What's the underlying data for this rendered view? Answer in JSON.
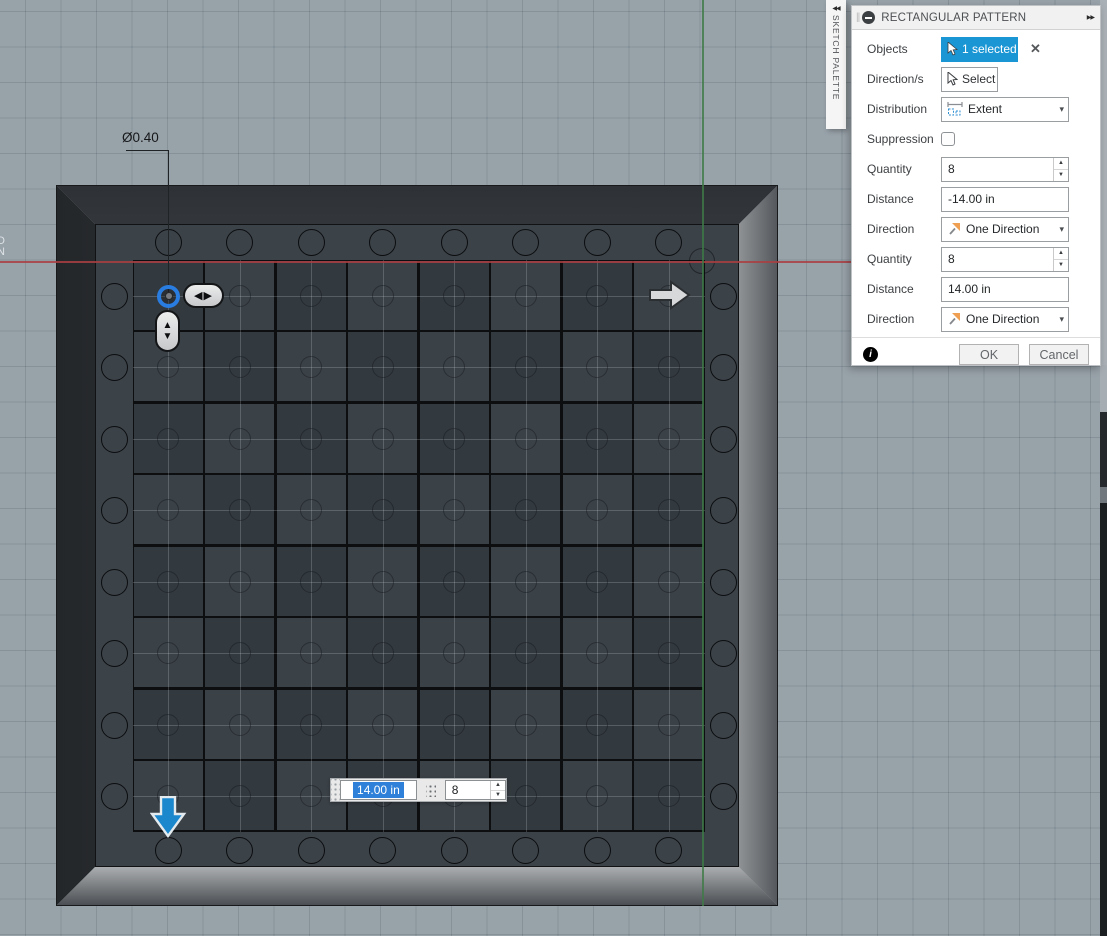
{
  "dialog": {
    "title": "RECTANGULAR PATTERN",
    "rows": {
      "objects_label": "Objects",
      "objects_value": "1 selected",
      "directions_label": "Direction/s",
      "directions_value": "Select",
      "distribution_label": "Distribution",
      "distribution_value": "Extent",
      "suppression_label": "Suppression",
      "quantity1_label": "Quantity",
      "quantity1_value": "8",
      "distance1_label": "Distance",
      "distance1_value": "-14.00 in",
      "direction1_label": "Direction",
      "direction1_value": "One Direction",
      "quantity2_label": "Quantity",
      "quantity2_value": "8",
      "distance2_label": "Distance",
      "distance2_value": "14.00 in",
      "direction2_label": "Direction",
      "direction2_value": "One Direction"
    },
    "ok_label": "OK",
    "cancel_label": "Cancel"
  },
  "sketch_palette": {
    "label": "SKETCH PALETTE"
  },
  "canvas": {
    "dimension_label": "Ø0.40",
    "floating_inputs": {
      "distance_value": "14.00 in",
      "quantity_value": "8"
    },
    "clipped_text_line1": "D",
    "clipped_text_line2": "N",
    "pattern": {
      "columns": 8,
      "rows": 8
    },
    "holes_per_side": 8
  },
  "icons": {
    "expand_right": "▶▶",
    "collapse_left": "◀◀",
    "close": "✕",
    "caret_down": "▾",
    "spinner_up": "▲",
    "spinner_down": "▼",
    "flip_horizontal": "◀▶",
    "pill_up": "▲",
    "pill_down": "▼",
    "info": "i"
  },
  "colors": {
    "accent_blue": "#1a96d5",
    "selection_blue": "#2f80d8",
    "axis_red": "#aa3e42",
    "axis_green": "#3e7a46",
    "direction_orange": "#f0a052",
    "extent_blue": "#2f8fd0"
  }
}
